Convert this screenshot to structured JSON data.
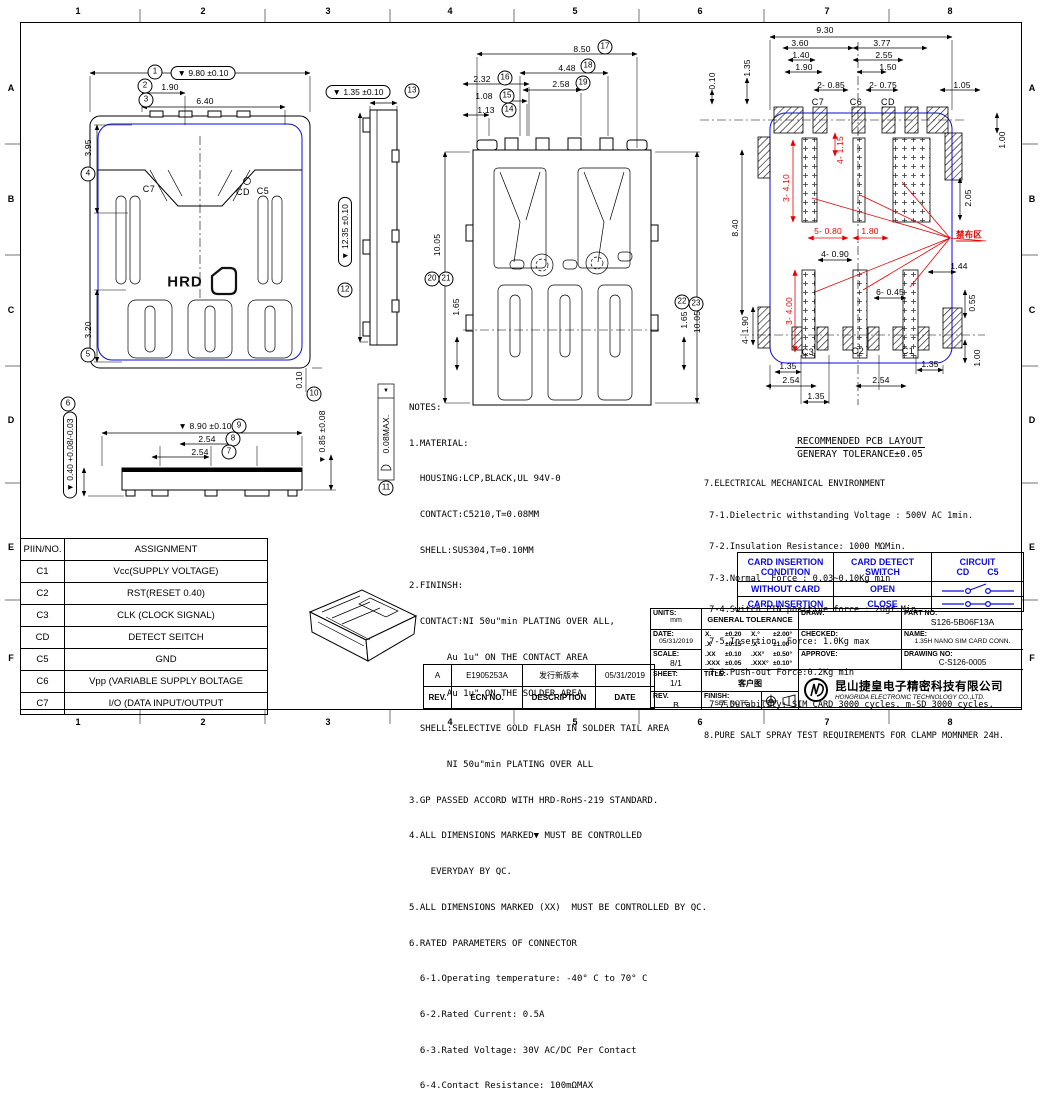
{
  "frame": {
    "cols": [
      "1",
      "2",
      "3",
      "4",
      "5",
      "6",
      "7",
      "8"
    ],
    "rows": [
      "A",
      "B",
      "C",
      "D",
      "E",
      "F"
    ]
  },
  "front": {
    "b1": "1",
    "d1": "▼ 9.80 ±0.10",
    "b2": "2",
    "d2": "1.90",
    "b3": "3",
    "d3": "6.40",
    "b4": "4",
    "d4": "3.95",
    "b5": "5",
    "d5": "3.20",
    "edge": "0.10",
    "c7": "C7",
    "cd": "CD",
    "c5": "C5",
    "logo": "HRD"
  },
  "bottom": {
    "b6": "6",
    "d6": "▼ 0.40 +0.08/-0.03",
    "b7": "7",
    "d7": "2.54",
    "b8": "8",
    "d8": "2.54",
    "b9": "9",
    "d9": "▼ 8.90 ±0.10"
  },
  "side": {
    "b10": "10",
    "d10": "▼ 0.85 ±0.08",
    "b11": "11",
    "d11": "0.08MAX.",
    "tri": "▼",
    "b12": "12",
    "d12": "▼ 12.35 ±0.10",
    "b13": "13",
    "d13": "▼ 1.35 ±0.10"
  },
  "back": {
    "b14": "14",
    "d14": "1.13",
    "b15": "15",
    "d15": "1.08",
    "b16": "16",
    "d16": "2.32",
    "b17": "17",
    "d17": "8.50",
    "b18": "18",
    "d18": "4.48",
    "b19": "19",
    "d19": "2.58",
    "b20": "20",
    "b21": "21",
    "d2021": "10.05",
    "d165l": "1.65",
    "b22": "22",
    "b23": "23",
    "d165r": "1.65",
    "d1005r": "10.05"
  },
  "pcb": {
    "d930": "9.30",
    "d360": "3.60",
    "d377": "3.77",
    "d140": "1.40",
    "d255": "2.55",
    "d190": "1.90",
    "d150": "1.50",
    "d2085": "2- 0.85",
    "d2075": "2- 0.75",
    "d105": "1.05",
    "d010": "0.10",
    "d135t": "1.35",
    "d100t": "1.00",
    "d205": "2.05",
    "d840": "8.40",
    "d4190": "4- 1.90",
    "d4090": "4- 0.90",
    "d6045": "6- 0.45",
    "d144": "1.44",
    "d055": "0.55",
    "d100b": "1.00",
    "d135bl": "1.35",
    "d135br": "1.35",
    "d254l": "2.54",
    "d254r": "2.54",
    "d135c": "1.35",
    "r3410": "3- 4.10",
    "r4115": "4- 1.15",
    "r5080": "5- 0.80",
    "r180": "1.80",
    "r3400": "3- 4.00",
    "keepout": "禁布区",
    "c7": "C7",
    "c6": "C6",
    "cd": "CD",
    "c3": "C3",
    "c2": "C2",
    "c1": "C1",
    "title": "RECOMMENDED PCB LAYOUT",
    "tolerance": "GENERAY TOLERANCE±0.05"
  },
  "notes_lines": [
    "NOTES:",
    "1.MATERIAL:",
    "  HOUSING:LCP,BLACK,UL 94V-0",
    "  CONTACT:C5210,T=0.08MM",
    "  SHELL:SUS304,T=0.10MM",
    "2.FININSH:",
    "  CONTACT:NI 50u\"min PLATING OVER ALL,",
    "       Au 1u\" ON THE CONTACT AREA",
    "       Au 1u\" ON THE SOLDER AREA",
    "  SHELL:SELECTIVE GOLD FLASH IN SOLDER TAIL AREA",
    "       NI 50u\"min PLATING OVER ALL",
    "3.GP PASSED ACCORD WITH HRD-RoHS-219 STANDARD.",
    "4.ALL DIMENSIONS MARKED▼ MUST BE CONTROLLED",
    "    EVERYDAY BY QC.",
    "5.ALL DIMENSIONS MARKED (XX)  MUST BE CONTROLLED BY QC.",
    "6.RATED PARAMETERS OF CONNECTOR",
    "  6-1.Operating temperature: -40° C to 70° C",
    "  6-2.Rated Current: 0.5A",
    "  6-3.Rated Voltage: 30V AC/DC Per Contact",
    "  6-4.Contact Resistance: 100mΩMAX"
  ],
  "env_lines": [
    "7.ELECTRICAL MECHANICAL ENVIRONMENT",
    " 7-1.Dielectric withstanding Voltage : 500V AC 1min.",
    " 7-2.Insulation Resistance: 1000 MΩMin.",
    " 7-3.Normal  Force : 0.03~0.10Kg min",
    " 7-4.Switch PIN positive force : 20gf.Min",
    " 7-5.Insertion  Force: 1.0Kg max",
    " 7-6.Push-out Force:0.2Kg min",
    " 7-7.Durability: SIM CARD 3000 cycles. m-SD 3000 cycles.",
    "8.PURE SALT SPRAY TEST REQUIREMENTS FOR CLAMP MOMNMER 24H."
  ],
  "card": {
    "h1a": "CARD INSERTION",
    "h1b": "CONDITION",
    "h2": "CARD DETECT SWITCH",
    "h3": "CIRCUIT",
    "cd": "CD",
    "c5": "C5",
    "r1c": "WITHOUT CARD",
    "r1s": "OPEN",
    "r2c": "CARD INSERTION",
    "r2s": "CLOSE"
  },
  "pin": {
    "h1": "PIIN/NO.",
    "h2": "ASSIGNMENT",
    "rows": [
      [
        "C1",
        "Vcc(SUPPLY VOLTAGE)"
      ],
      [
        "C2",
        "RST(RESET 0.40)"
      ],
      [
        "C3",
        "CLK (CLOCK SIGNAL)"
      ],
      [
        "CD",
        "DETECT SEITCH"
      ],
      [
        "C5",
        "GND"
      ],
      [
        "C6",
        "Vpp (VARIABLE SUPPLY BOLTAGE"
      ],
      [
        "C7",
        "I/O (DATA INPUT/OUTPUT"
      ]
    ]
  },
  "rev": {
    "h": [
      "REV.",
      "ECN NO.",
      "DESCRIPTION",
      "DATE"
    ],
    "r1": [
      "A",
      "E1905253A",
      "发行新版本",
      "05/31/2019"
    ]
  },
  "tb": {
    "units_l": "UNITS:",
    "units": "mm",
    "date_l": "DATE:",
    "date": "05/31/2019",
    "scale_l": "SCALE:",
    "scale": "8/1",
    "sheet_l": "SHEET:",
    "sheet": "1/1",
    "rev_l": "REV.",
    "rev": "B",
    "gt": "GENERAL TOLERANCE",
    "tol": [
      [
        "X.",
        "±0.20",
        "X.°",
        "±2.00°"
      ],
      [
        ".X",
        "±0.15",
        ".X°",
        "±1.00°"
      ],
      [
        ".XX",
        "±0.10",
        ".XX°",
        "±0.50°"
      ],
      [
        ".XXX",
        "±0.05",
        ".XXX°",
        "±0.10°"
      ]
    ],
    "title_l": "TITLE:",
    "title": "客户图",
    "finish_l": "FINISH:",
    "finish": "SEE NOTE",
    "draw_l": "DRAW:",
    "checked_l": "CHECKED:",
    "approve_l": "APPROVE:",
    "part_l": "PART NO:",
    "part": "S126-5B06F13A",
    "name_l": "NAME:",
    "name": "1.35H NANO SIM CARD CONN.",
    "dwg_l": "DRAWING NO:",
    "dwg": "C-S126-0005",
    "cn": "昆山捷皇电子精密科技有限公司",
    "en": "HONGRIDA ELECTRONIC TECHNOLOGY CO.,LTD."
  }
}
